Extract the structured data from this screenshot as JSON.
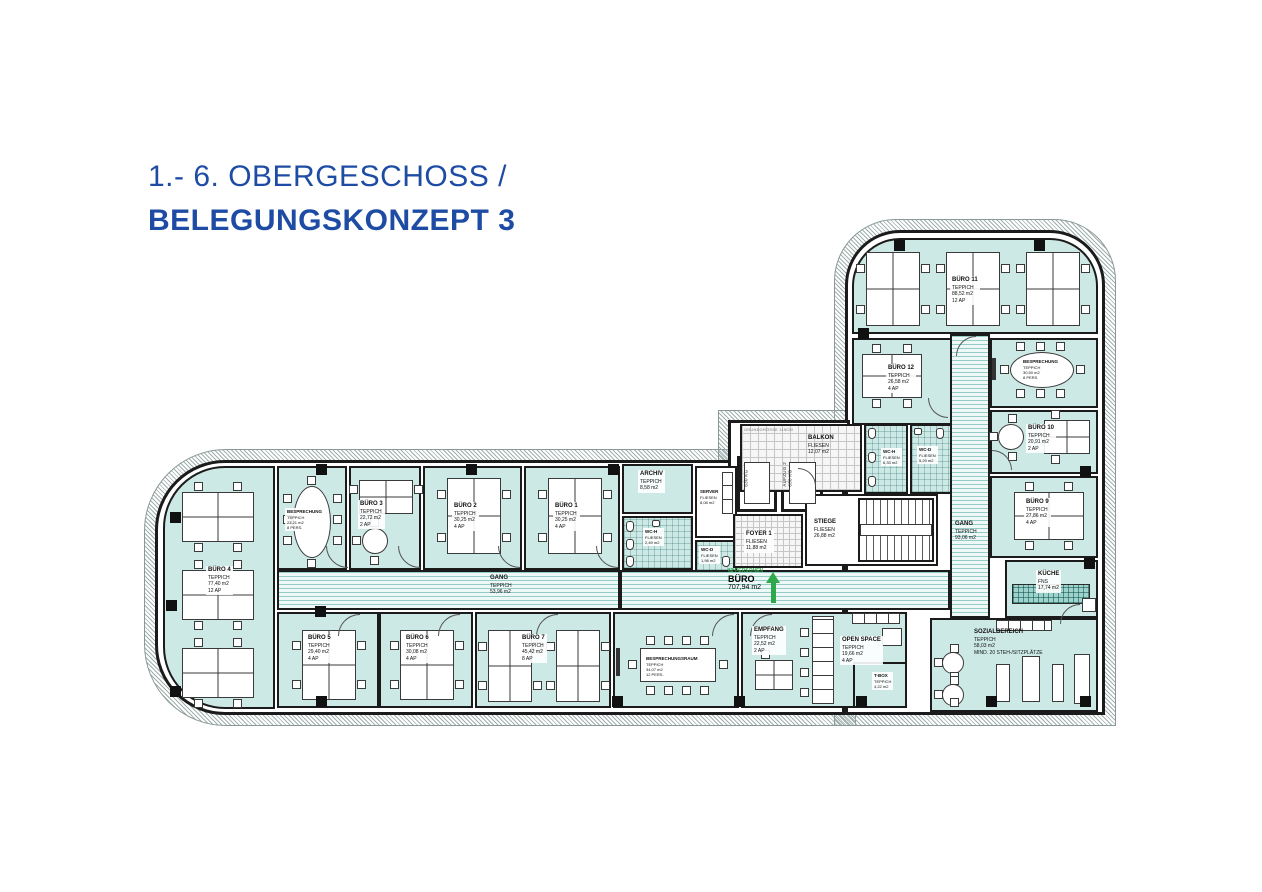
{
  "header": {
    "line1": "1.- 6. OBERGESCHOSS /",
    "line2": "BELEGUNGSKONZEPT 3"
  },
  "colors": {
    "accent": "#1e4ca4",
    "room_fill": "#cde9e6",
    "green": "#2ea84a",
    "wall": "#1b1b1b"
  },
  "rooms": {
    "buero1": {
      "name": "BÜRO 1",
      "floor": "TEPPICH",
      "area": "30,25 m2",
      "cap": "4 AP"
    },
    "buero2": {
      "name": "BÜRO 2",
      "floor": "TEPPICH",
      "area": "30,25 m2",
      "cap": "4 AP"
    },
    "buero3": {
      "name": "BÜRO 3",
      "floor": "TEPPICH",
      "area": "22,72 m2",
      "cap": "2 AP"
    },
    "buero4": {
      "name": "BÜRO 4",
      "floor": "TEPPICH",
      "area": "77,40 m2",
      "cap": "12 AP"
    },
    "buero5": {
      "name": "BÜRO 5",
      "floor": "TEPPICH",
      "area": "29,40 m2",
      "cap": "4 AP"
    },
    "buero6": {
      "name": "BÜRO 6",
      "floor": "TEPPICH",
      "area": "30,08 m2",
      "cap": "4 AP"
    },
    "buero7": {
      "name": "BÜRO 7",
      "floor": "TEPPICH",
      "area": "45,42 m2",
      "cap": "8 AP"
    },
    "buero9": {
      "name": "BÜRO 9",
      "floor": "TEPPICH",
      "area": "27,86 m2",
      "cap": "4 AP"
    },
    "buero10": {
      "name": "BÜRO 10",
      "floor": "TEPPICH",
      "area": "20,91 m2",
      "cap": "2 AP"
    },
    "buero11": {
      "name": "BÜRO 11",
      "floor": "TEPPICH",
      "area": "88,52 m2",
      "cap": "12 AP"
    },
    "buero12": {
      "name": "BÜRO 12",
      "floor": "TEPPICH",
      "area": "26,58 m2",
      "cap": "4 AP"
    },
    "besprechung_west": {
      "name": "BESPRECHUNG",
      "floor": "TEPPICH",
      "area": "23,21 m2",
      "cap": "8 PERS."
    },
    "besprechung_nord": {
      "name": "BESPRECHUNG",
      "floor": "TEPPICH",
      "area": "30,50 m2",
      "cap": "8 PERS."
    },
    "besprechungsraum": {
      "name": "BESPRECHUNGSRAUM",
      "floor": "TEPPICH",
      "area": "34,07 m2",
      "cap": "12 PERS."
    },
    "empfang": {
      "name": "EMPFANG",
      "floor": "TEPPICH",
      "area": "22,52 m2",
      "cap": "2 AP"
    },
    "openspace": {
      "name": "OPEN SPACE",
      "floor": "TEPPICH",
      "area": "19,66 m2",
      "cap": "4 AP"
    },
    "tbox": {
      "name": "T-BOX",
      "floor": "TEPPICH",
      "area": "4,22 m2"
    },
    "sozialbereich": {
      "name": "SOZIALBEREICH",
      "floor": "TEPPICH",
      "area": "58,03 m2",
      "cap": "MIND. 20 STEH-/SITZPLÄTZE"
    },
    "kueche": {
      "name": "KÜCHE",
      "floor": "FNS",
      "area": "17,74 m2"
    },
    "gang_west": {
      "name": "GANG",
      "floor": "TEPPICH",
      "area": "53,96 m2"
    },
    "gang_ost": {
      "name": "GANG",
      "floor": "TEPPICH",
      "area": "93,06 m2"
    },
    "archiv": {
      "name": "ARCHIV",
      "floor": "TEPPICH",
      "area": "8,58 m2"
    },
    "server": {
      "name": "SERVER",
      "floor": "FLIESEN",
      "area": "8,08 m2"
    },
    "foyer": {
      "name": "FOYER 1",
      "floor": "FLIESEN",
      "area": "11,88 m2"
    },
    "stiege": {
      "name": "STIEGE",
      "floor": "FLIESEN",
      "area": "26,88 m2"
    },
    "balkon": {
      "name": "BALKON",
      "floor": "FLIESEN",
      "area": "12,07 m2"
    },
    "wc_h": {
      "name": "WC-H",
      "floor": "FLIESEN",
      "area": "6,33 m2"
    },
    "wc_d": {
      "name": "WC-D",
      "floor": "FLIESEN",
      "area": "5,29 m2"
    },
    "wc_h_mid": {
      "name": "WC-H",
      "floor": "FLIESEN",
      "area": "2,49 m2"
    },
    "wc_d_mid": {
      "name": "WC-D",
      "floor": "FLIESEN",
      "area": "1,98 m2"
    }
  },
  "annotations": {
    "total_label": "BÜRO",
    "total_area": "707,94 m2",
    "total_persons": "62 PERSONEN",
    "grundgroesse": "GRUNDGRÖSSE 115CM",
    "aufzug1": "AUFZUG 1",
    "aufzug2": "AUFZUG 2",
    "aufzug_cap": "630 KG"
  }
}
